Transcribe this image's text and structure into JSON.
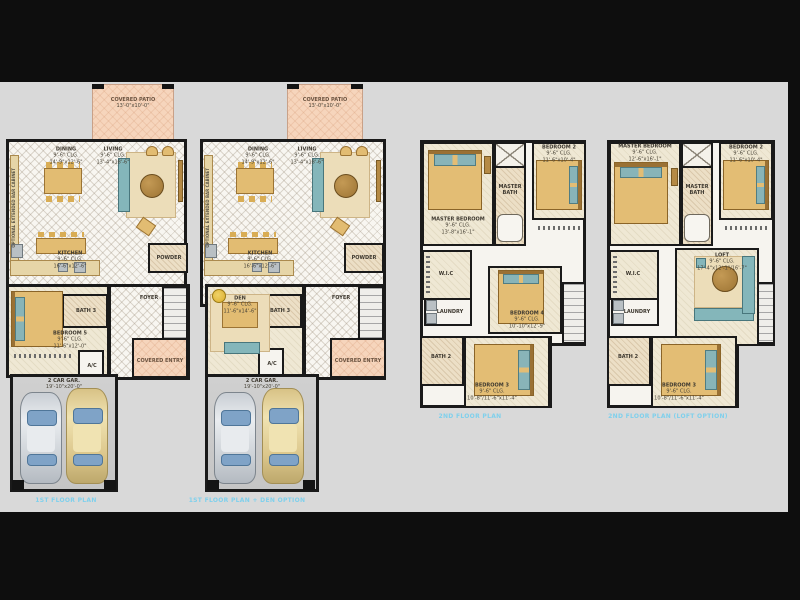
{
  "colors": {
    "background": "#0e0e0e",
    "canvas": "#d9d9d9",
    "caption_blue": "#7fd0ec",
    "patio_pink": "#f6d5bc",
    "furniture_tan": "#e2bc72",
    "furniture_teal": "#84b6ba"
  },
  "p1": {
    "patio_name": "COVERED PATIO",
    "patio_dims": "13'-0\"x10'-0\"",
    "dining_name": "DINING",
    "dining_clg": "9'-6\" CLG.",
    "dining_dims": "14'-9\"x12'-6\"",
    "living_name": "LIVING",
    "living_clg": "9'-6\" CLG.",
    "living_dims": "13'-4\"x18'-6\"",
    "kitchen_name": "KITCHEN",
    "kitchen_clg": "9'-6\" CLG.",
    "kitchen_dims": "16'-6\"x12'-6\"",
    "powder": "POWDER",
    "foyer": "FOYER",
    "bath": "BATH 3",
    "bed5_name": "BEDROOM 5",
    "bed5_clg": "9'-6\" CLG.",
    "bed5_dims": "11'-6\"x12'-0\"",
    "ac": "A/C",
    "entry": "COVERED ENTRY",
    "garage_name": "2 CAR GAR.",
    "garage_dims": "19'-10\"x20'-0\"",
    "cabinet": "OPTIONAL EXTENDED BAR CABINET",
    "caption": "1ST FLOOR PLAN"
  },
  "p2": {
    "patio_name": "COVERED PATIO",
    "patio_dims": "13'-0\"x10'-0\"",
    "dining_name": "DINING",
    "dining_clg": "9'-6\" CLG.",
    "dining_dims": "14'-9\"x12'-6\"",
    "living_name": "LIVING",
    "living_clg": "9'-6\" CLG.",
    "living_dims": "13'-4\"x18'-6\"",
    "kitchen_name": "KITCHEN",
    "kitchen_clg": "9'-6\" CLG.",
    "kitchen_dims": "16'-6\"x12'-6\"",
    "powder": "POWDER",
    "foyer": "FOYER",
    "bath": "BATH 3",
    "den_name": "DEN",
    "den_clg": "9'-6\" CLG.",
    "den_dims": "11'-6\"x14'-6\"",
    "ac": "A/C",
    "entry": "COVERED ENTRY",
    "garage_name": "2 CAR GAR.",
    "garage_dims": "19'-10\"x20'-0\"",
    "cabinet": "OPTIONAL EXTENDED BAR CABINET",
    "caption": "1ST FLOOR PLAN + DEN OPTION"
  },
  "p3": {
    "master_name": "MASTER BEDROOM",
    "master_clg": "9'-6\" CLG.",
    "master_dims": "13'-8\"x16'-1\"",
    "mbath1": "MASTER",
    "mbath2": "BATH",
    "bed2_name": "BEDROOM 2",
    "bed2_clg": "9'-6\" CLG.",
    "bed2_dims": "11'-6\"x10'-4\"",
    "wic": "W.I.C",
    "laundry": "LAUNDRY",
    "bed4_name": "BEDROOM 4",
    "bed4_clg": "9'-6\" CLG.",
    "bed4_dims": "10'-10\"x12'-9\"",
    "bath2": "BATH 2",
    "bed3_name": "BEDROOM 3",
    "bed3_clg": "9'-6\" CLG.",
    "bed3_dims": "10'-8\"/11'-6\"x11'-4\"",
    "caption": "2ND FLOOR PLAN"
  },
  "p4": {
    "master_name": "MASTER BEDROOM",
    "master_clg": "9'-6\" CLG.",
    "master_dims": "12'-6\"x16'-1\"",
    "mbath1": "MASTER",
    "mbath2": "BATH",
    "bed2_name": "BEDROOM 2",
    "bed2_clg": "9'-6\" CLG.",
    "bed2_dims": "11'-6\"x10'-4\"",
    "wic": "W.I.C",
    "laundry": "LAUNDRY",
    "loft_name": "LOFT",
    "loft_clg": "9'-6\" CLG.",
    "loft_dims": "17'-4\"x12'-1\"/16'-7\"",
    "bath2": "BATH 2",
    "bed3_name": "BEDROOM 3",
    "bed3_clg": "9'-6\" CLG.",
    "bed3_dims": "10'-8\"/11'-6\"x11'-4\"",
    "caption": "2ND FLOOR PLAN (LOFT OPTION)"
  }
}
